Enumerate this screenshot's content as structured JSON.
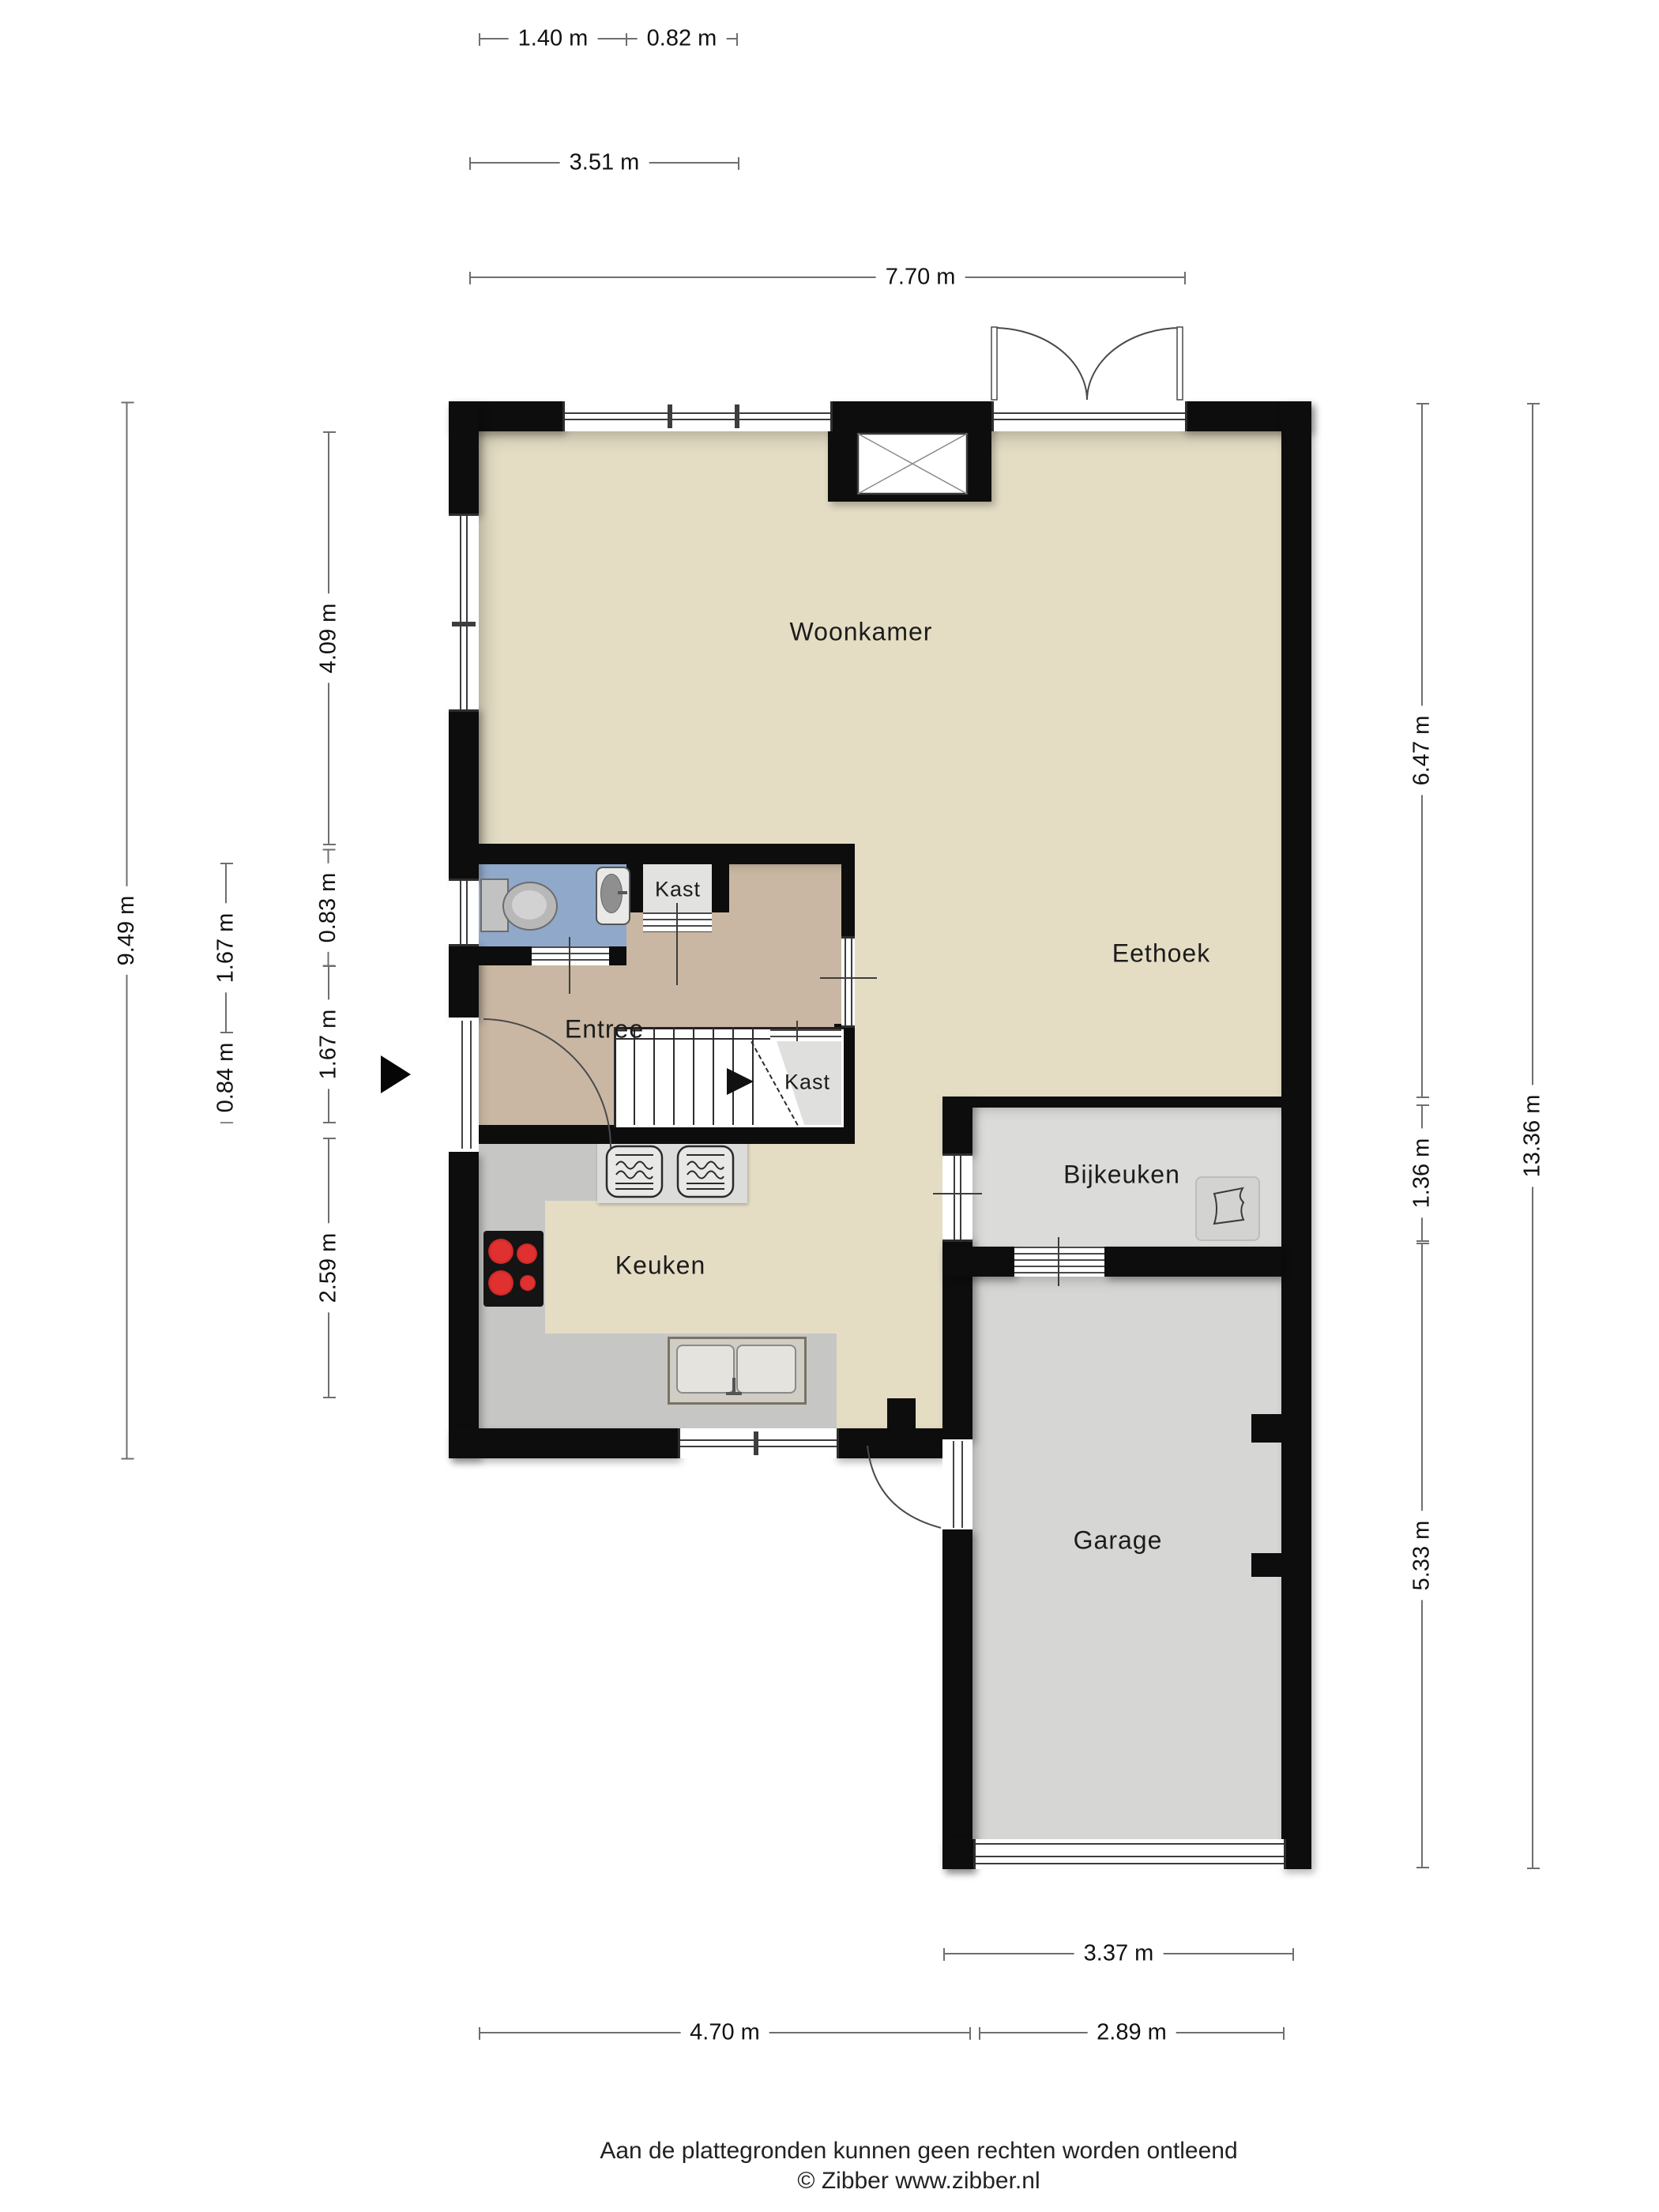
{
  "rooms": {
    "woonkamer": "Woonkamer",
    "eethoek": "Eethoek",
    "entree": "Entree",
    "kast_hal": "Kast",
    "kast_trap": "Kast",
    "keuken": "Keuken",
    "bijkeuken": "Bijkeuken",
    "garage": "Garage"
  },
  "dimensions": {
    "top": {
      "w140": "1.40 m",
      "w082": "0.82 m",
      "w351": "3.51 m",
      "w770": "7.70 m"
    },
    "left": {
      "h949": "9.49 m",
      "h167a": "1.67 m",
      "h084": "0.84 m",
      "h409": "4.09 m",
      "h083": "0.83 m",
      "h167b": "1.67 m",
      "h259": "2.59 m"
    },
    "right": {
      "h647": "6.47 m",
      "h136": "1.36 m",
      "h533": "5.33 m",
      "h1336": "13.36 m"
    },
    "bottom": {
      "w337": "3.37 m",
      "w470": "4.70 m",
      "w289": "2.89 m"
    }
  },
  "footer": {
    "disclaimer": "Aan de plattegronden kunnen geen rechten worden ontleend",
    "copyright": "© Zibber www.zibber.nl"
  },
  "colors": {
    "wall": "#0d0d0d",
    "floor_living": "#e4ddc4",
    "floor_entree": "#c9b7a3",
    "floor_toilet": "#90a8ca",
    "floor_closet": "#e2e2e0",
    "floor_utility": "#dbdbd9",
    "floor_garage": "#d6d6d4",
    "counter": "#c6c6c4",
    "burner_red": "#c32222"
  }
}
